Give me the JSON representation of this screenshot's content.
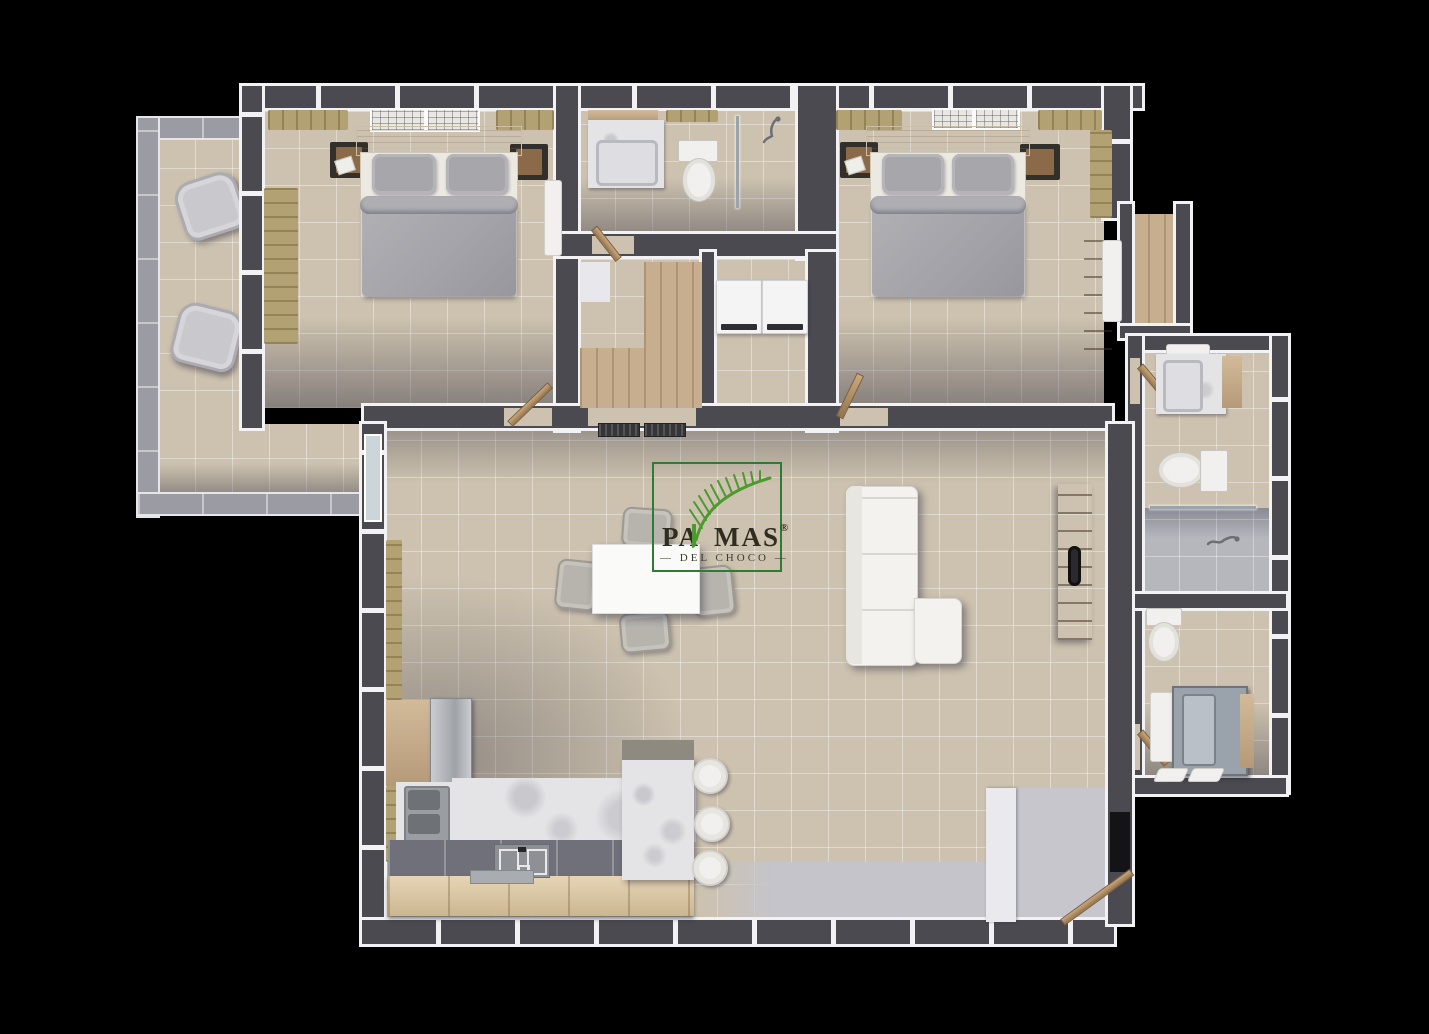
{
  "logo": {
    "brand_left": "PA",
    "brand_right": "MAS",
    "registered": "®",
    "dash_left": "—",
    "dash_right": "—",
    "subtitle": "DEL CHOCO"
  },
  "colors": {
    "background": "#000000",
    "wall": "#4a4a50",
    "wall_trim": "#f2f2f4",
    "floor_tile": "#cdc2af",
    "floor_grout": "#e0d8ca",
    "wood": "#c7ae8e",
    "wood_dark": "#9b7d5c",
    "tan": "#b2a172",
    "duvet": "#a6a6ab",
    "furniture_white": "#f1f0ee",
    "marble": "#e4e3e5",
    "steel": "#a8abb0",
    "dark_furniture": "#332f2b",
    "rail": "#9b9ba3",
    "concrete": "#c4c4ca",
    "glass": "#ccd5da",
    "logo_green": "#2e7c34",
    "leaf": "#4c9a2e",
    "logo_text": "#302d20"
  }
}
